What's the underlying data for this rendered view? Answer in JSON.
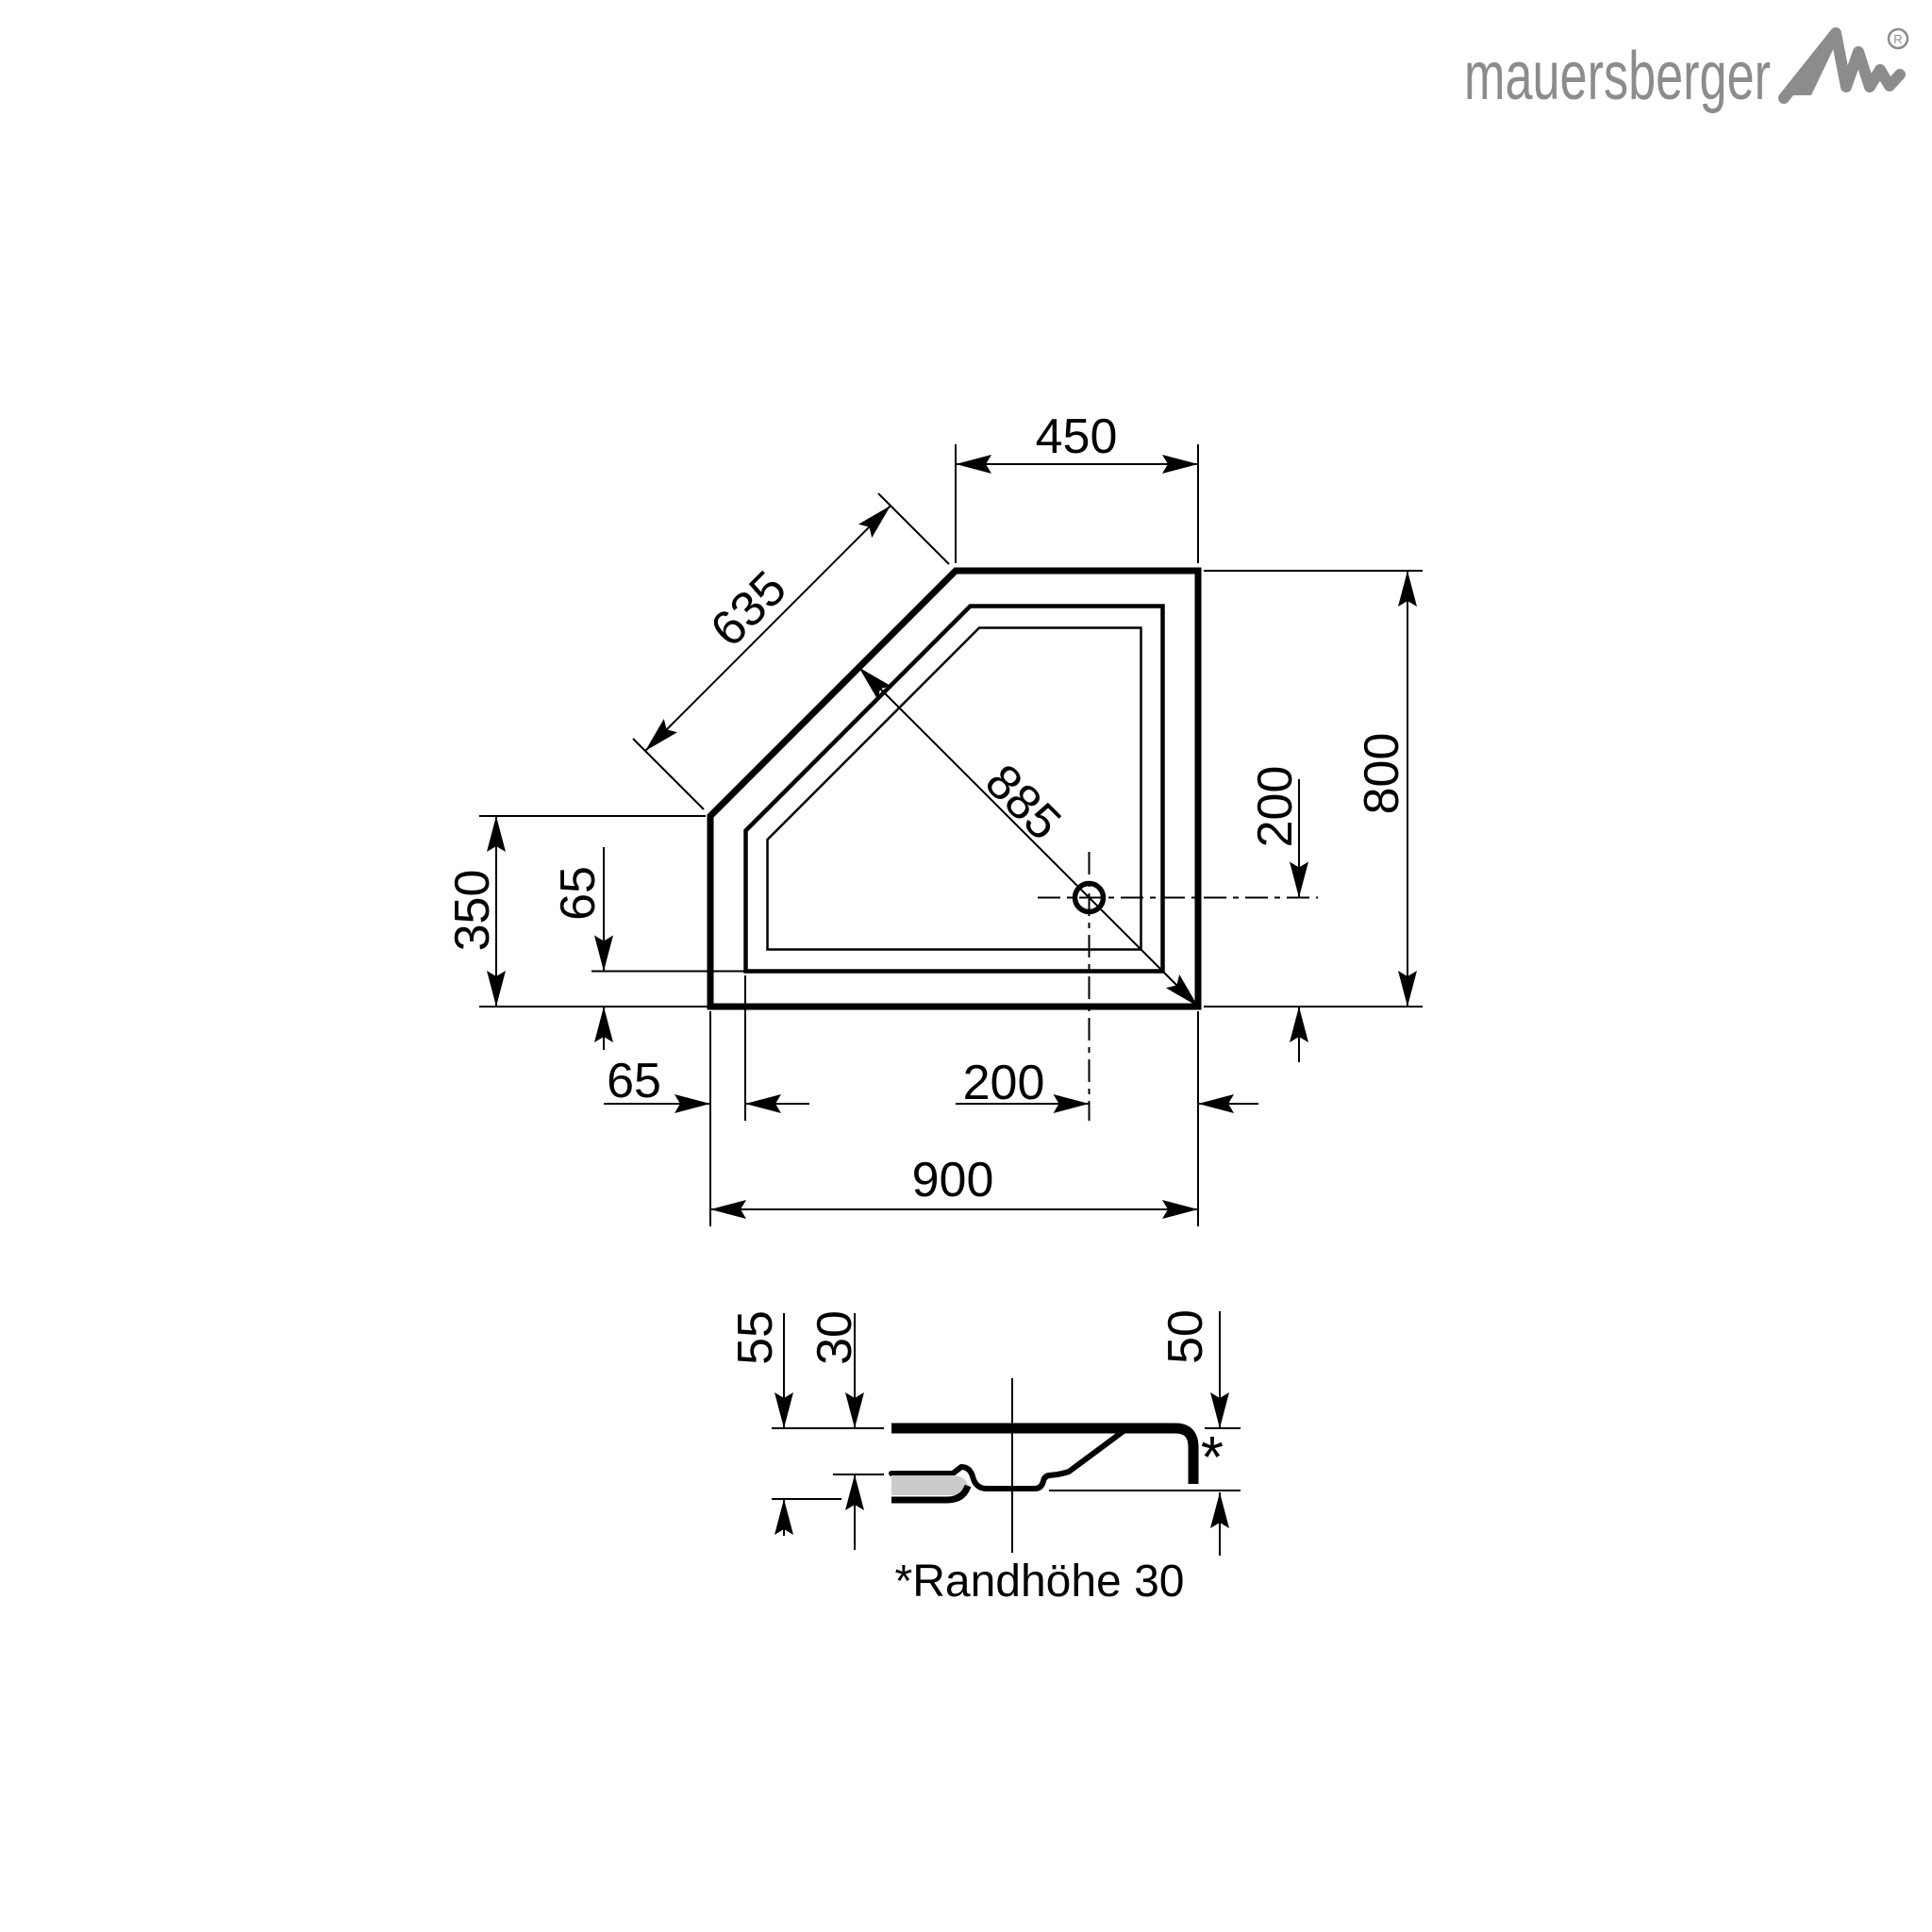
{
  "brand": {
    "name": "mauersberger",
    "registered_mark": "R",
    "logo_color": "#8c8c8c"
  },
  "plan_view": {
    "description": "pentagonal shower tray, top view",
    "dims": {
      "top_width": "450",
      "chamfer_edge": "635",
      "chamfer_to_corner_diagonal": "885",
      "right_height": "800",
      "drain_to_bottom": "200",
      "left_edge_height": "350",
      "rim_width_left": "65",
      "rim_width_bottom": "65",
      "drain_to_right": "200",
      "total_width": "900"
    }
  },
  "section_view": {
    "description": "side section of tray",
    "dims": {
      "total_height": "55",
      "top_to_floor": "30",
      "outer_rim_height": "50"
    },
    "asterisk": "*",
    "footnote": "*Randhöhe 30"
  },
  "colors": {
    "line": "#000000",
    "logo": "#8c8c8c",
    "floor_fill": "#cbcbcb",
    "background": "#ffffff"
  }
}
